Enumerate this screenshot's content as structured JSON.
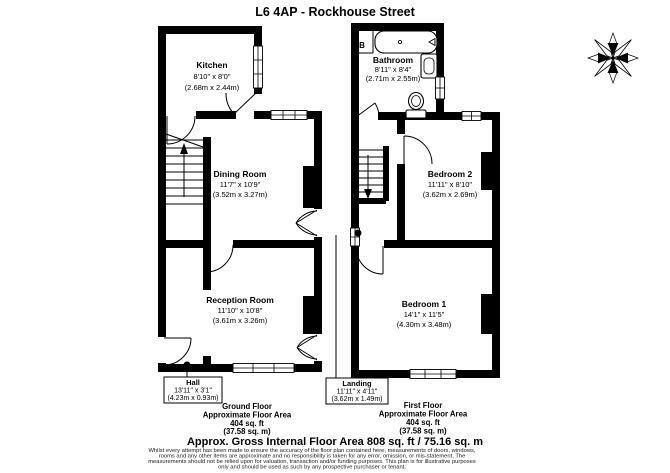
{
  "title": "L6 4AP - Rockhouse Street",
  "rooms": {
    "kitchen": {
      "name": "Kitchen",
      "dims": "8'10\" x 8'0\"",
      "metric": "(2.68m x 2.44m)"
    },
    "bathroom": {
      "name": "Bathroom",
      "dims": "8'11\" x 8'4\"",
      "metric": "(2.71m x 2.55m)"
    },
    "dining_room": {
      "name": "Dining Room",
      "dims": "11'7\" x 10'9\"",
      "metric": "(3.52m x 3.27m)"
    },
    "bedroom2": {
      "name": "Bedroom 2",
      "dims": "11'11\" x 8'10\"",
      "metric": "(3.62m x 2.69m)"
    },
    "reception_room": {
      "name": "Reception Room",
      "dims": "11'10\" x 10'8\"",
      "metric": "(3.61m x 3.26m)"
    },
    "bedroom1": {
      "name": "Bedroom 1",
      "dims": "14'1\" x 11'5\"",
      "metric": "(4.30m x 3.48m)"
    },
    "hall": {
      "name": "Hall",
      "dims": "13'11\" x 3'1\"",
      "metric": "(4.23m x 0.93m)"
    },
    "landing": {
      "name": "Landing",
      "dims": "11'11\" x 4'11\"",
      "metric": "(3.62m x 1.49m)"
    }
  },
  "labels": {
    "boiler": "B"
  },
  "floor_summaries": {
    "ground": {
      "floor_name": "Ground Floor",
      "area_label": "Approximate Floor Area",
      "area_ft": "404 sq. ft",
      "area_m": "(37.58 sq. m)"
    },
    "first": {
      "floor_name": "First Floor",
      "area_label": "Approximate Floor Area",
      "area_ft": "404 sq. ft",
      "area_m": "(37.58 sq. m)"
    }
  },
  "total_area": "Approx. Gross Internal Floor Area 808 sq. ft / 75.16 sq. m",
  "disclaimer": {
    "line1": "Whilst every attempt has been made to ensure the accuracy of the floor plan contained here, measurements of doors, windows,",
    "line2": "rooms and any other items are approximate and no responsibility is taken for any error, omission, or mis-statement. The",
    "line3": "measurements should not be relied upon for valuation, transaction and/or funding purposes. This plan is for illustrative purposes",
    "line4": "only and should be used as such by any prospective purchaser or tenant."
  }
}
